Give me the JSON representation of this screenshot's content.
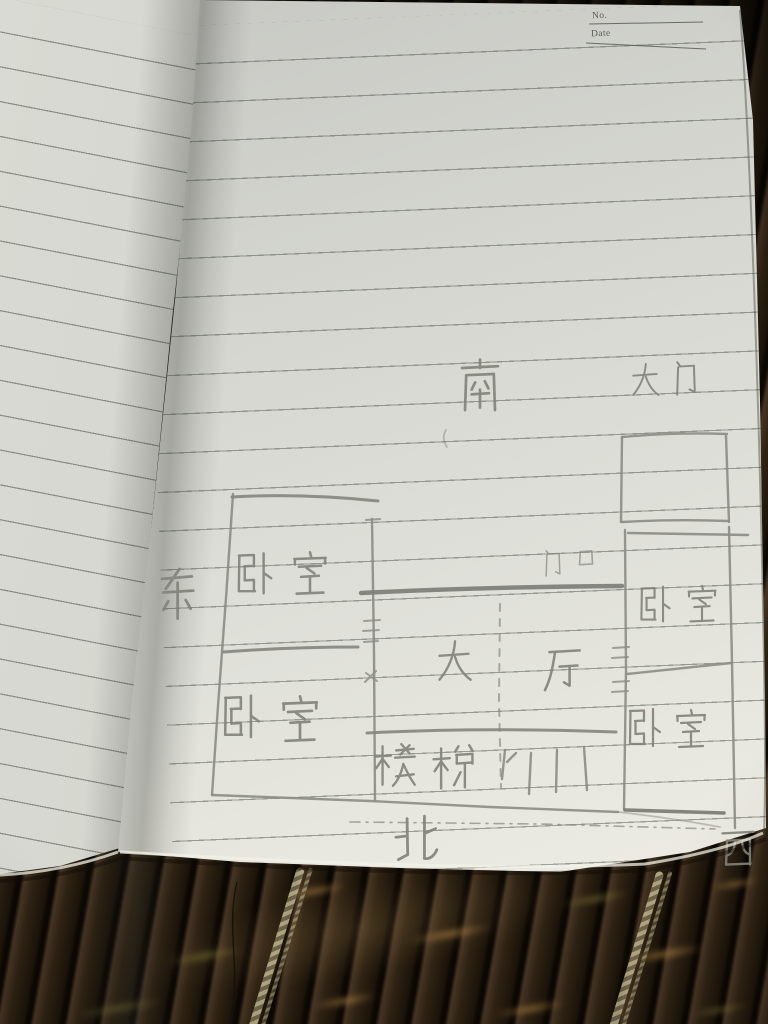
{
  "header": {
    "no_label": "No.",
    "date_label": "Date"
  },
  "floor_plan": {
    "type": "hand-drawn pencil floor plan on ruled notebook page",
    "compass": {
      "south": "南",
      "north": "北",
      "east": "东",
      "west": "西"
    },
    "labels": {
      "main_gate": "大门",
      "doorway": "门口",
      "hall": "大厅",
      "stairs": "楼梯",
      "bedroom": "卧室"
    },
    "rooms": [
      {
        "label": "卧室",
        "position": "upper-left"
      },
      {
        "label": "卧室",
        "position": "lower-left"
      },
      {
        "label": "卧室",
        "position": "right-upper"
      },
      {
        "label": "卧室",
        "position": "right-lower"
      },
      {
        "label": "大厅",
        "position": "center"
      },
      {
        "label": "楼梯",
        "position": "bottom-center"
      },
      {
        "label": "大门",
        "position": "outside-top-right"
      },
      {
        "label": "门口",
        "position": "on-hall-top-wall"
      }
    ]
  },
  "colors": {
    "paper": "#dfdfd8",
    "ruled_line": "#5f6a60",
    "pencil": "#8b8c84",
    "mat_dark": "#241a0e",
    "cord": "#c2b68e"
  }
}
